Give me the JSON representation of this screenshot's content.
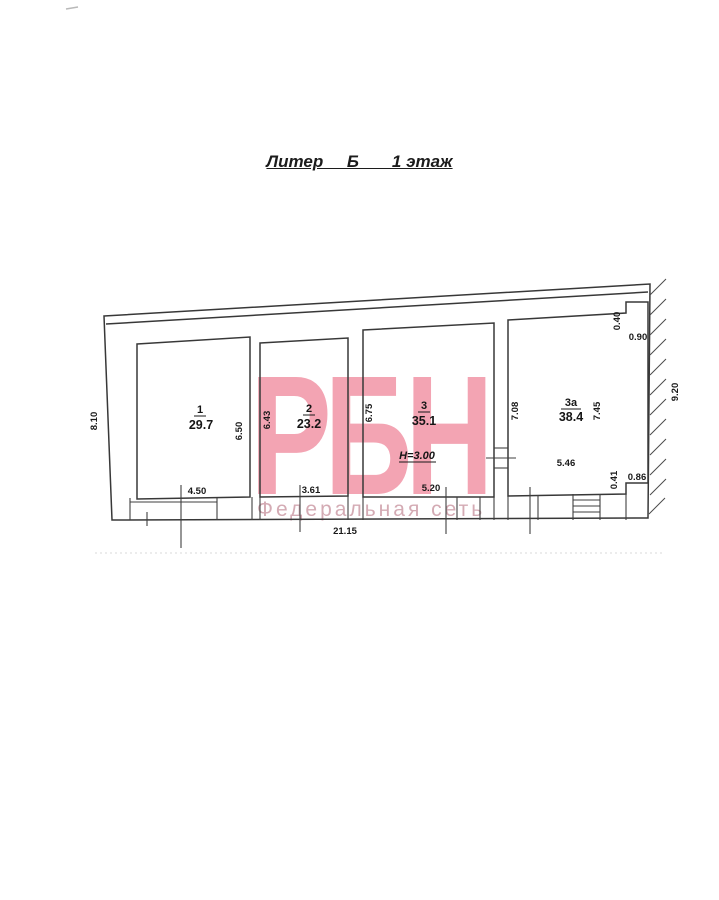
{
  "title": "Литер     Б       1 этаж",
  "watermark": {
    "logo": "РБН",
    "tagline": "Федеральная сеть",
    "logo_color": "#f3a4b3",
    "tagline_color": "#d4abb4"
  },
  "rooms": [
    {
      "number": "1",
      "area": "29.7"
    },
    {
      "number": "2",
      "area": "23.2"
    },
    {
      "number": "3",
      "area": "35.1",
      "height_note": "Н=3.00"
    },
    {
      "number": "3а",
      "area": "38.4"
    }
  ],
  "dimensions": {
    "left_height": "8.10",
    "right_height": "9.20",
    "total_width": "21.15",
    "room1_height": "6.50",
    "room1_width": "4.50",
    "room2_height": "6.43",
    "room2_width": "3.61",
    "room3_height": "6.75",
    "room3_width": "5.20",
    "room3a_left_height": "7.08",
    "room3a_right_height": "7.45",
    "room3a_width": "5.46",
    "notch_top_v": "0.40",
    "notch_top_h": "0.90",
    "notch_bottom_v": "0.41",
    "notch_bottom_h": "0.86"
  }
}
